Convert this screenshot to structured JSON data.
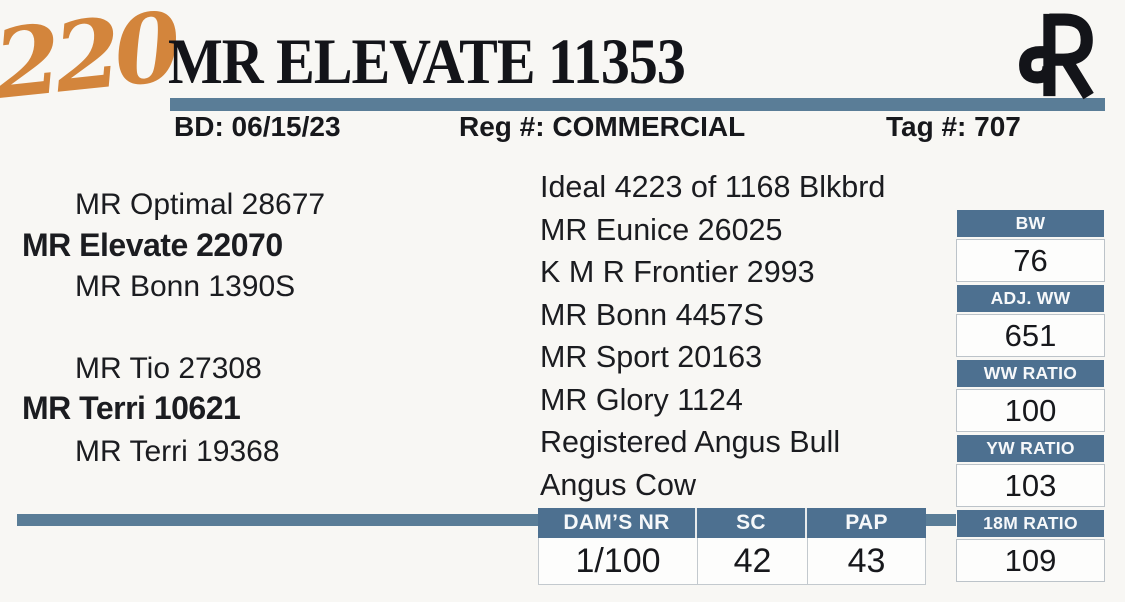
{
  "lot_number": "220",
  "title": "MR ELEVATE 11353",
  "header": {
    "bd": "BD: 06/15/23",
    "reg": "Reg #: COMMERCIAL",
    "tag": "Tag #: 707"
  },
  "pedigree": {
    "sire": {
      "top": "MR Optimal 28677",
      "main": "MR Elevate 22070",
      "bottom": "MR Bonn 1390S"
    },
    "dam": {
      "top": "MR Tio 27308",
      "main": "MR Terri 10621",
      "bottom": "MR Terri 19368"
    }
  },
  "ancestry": [
    "Ideal 4223 of 1168 Blkbrd",
    "MR Eunice 26025",
    "K M R Frontier 2993",
    "MR Bonn 4457S",
    "MR Sport 20163",
    "MR Glory 1124",
    "Registered Angus Bull",
    "Angus Cow"
  ],
  "stats": [
    {
      "label": "BW",
      "value": "76"
    },
    {
      "label": "ADJ. WW",
      "value": "651"
    },
    {
      "label": "WW RATIO",
      "value": "100"
    },
    {
      "label": "YW RATIO",
      "value": "103"
    },
    {
      "label": "18M RATIO",
      "value": "109"
    }
  ],
  "bottom_table": {
    "headers": [
      "DAM’S NR",
      "SC",
      "PAP"
    ],
    "values": [
      "1/100",
      "42",
      "43"
    ]
  },
  "colors": {
    "accent_blue": "#4d7090",
    "rule_blue": "#5a7d97",
    "lot_orange": "#d3853c",
    "background": "#f8f7f4"
  },
  "icons": {
    "brand": "rafter-r-brand"
  }
}
